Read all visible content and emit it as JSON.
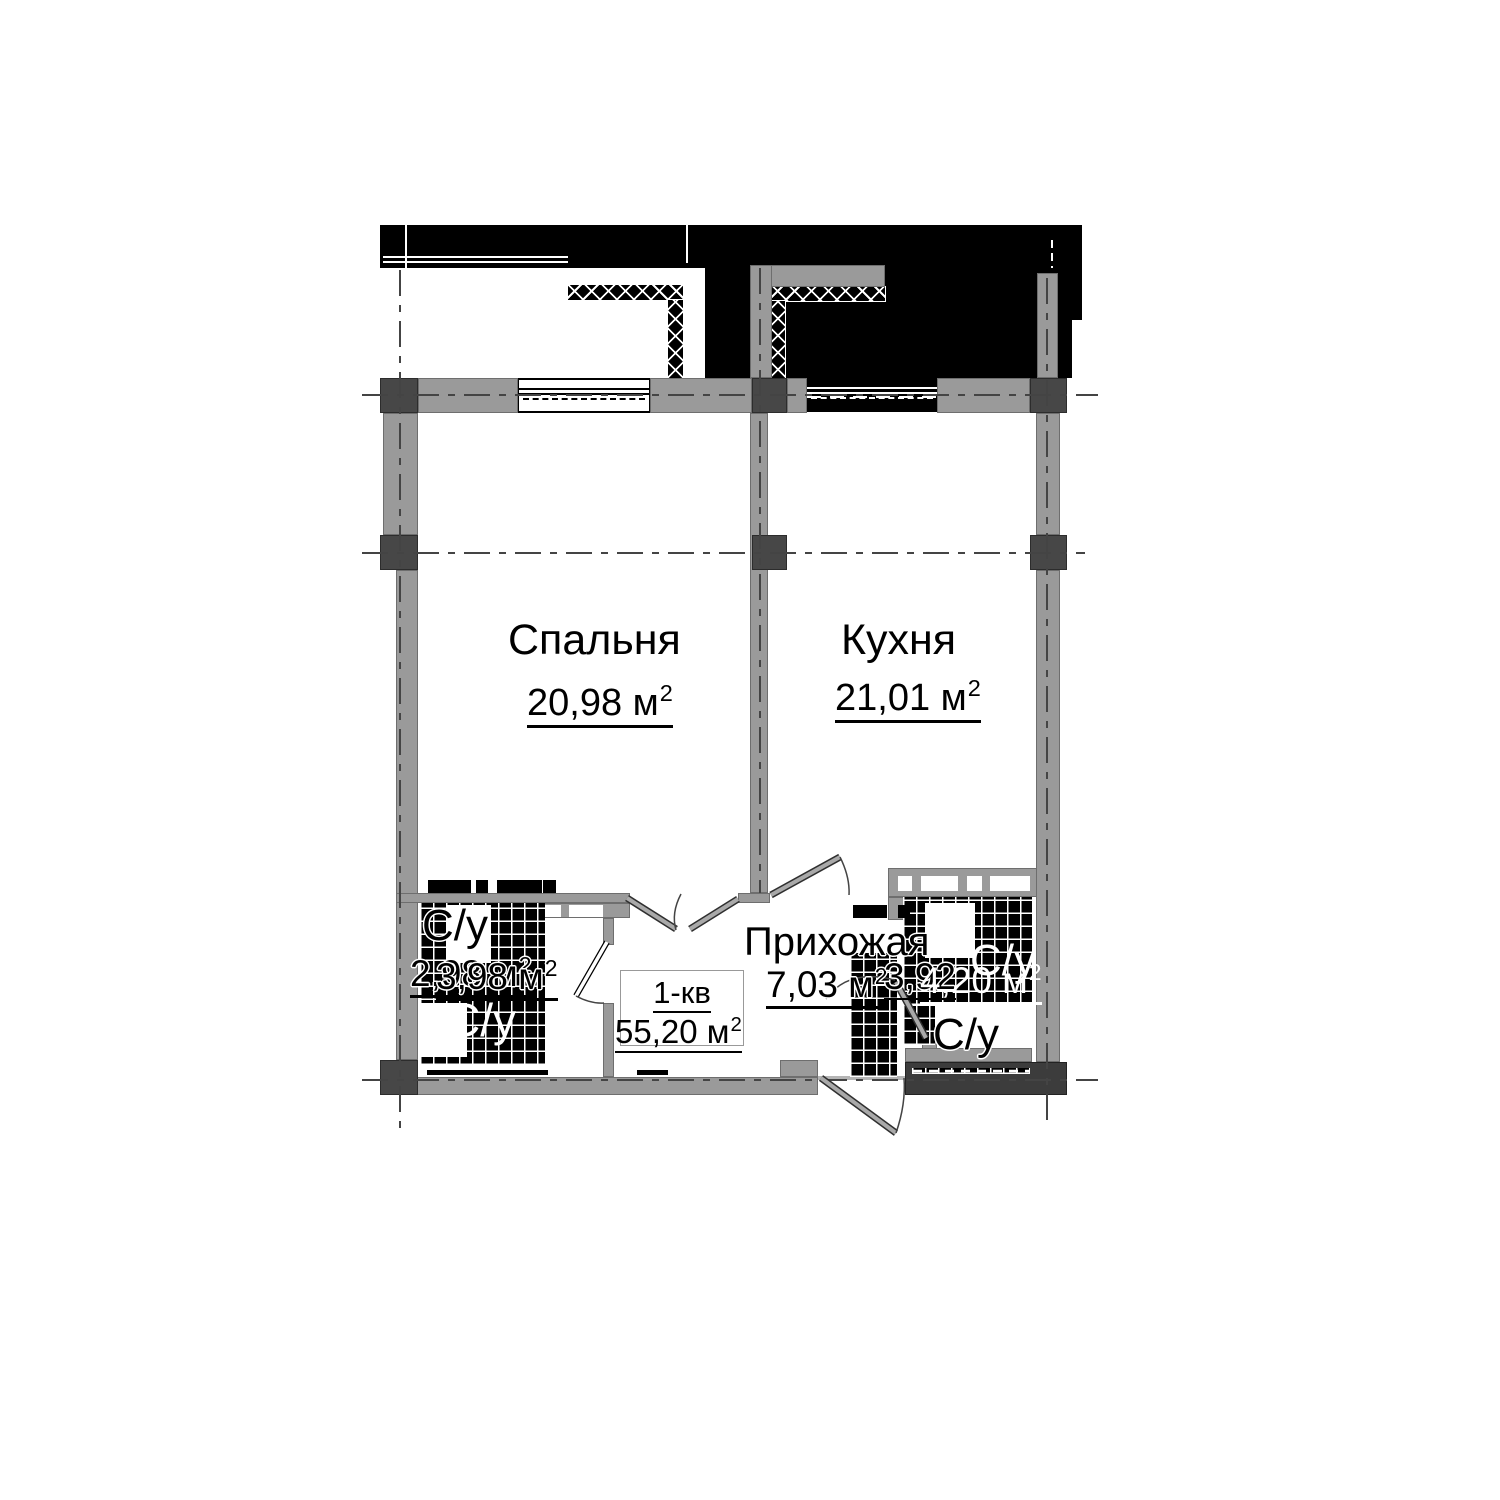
{
  "plan": {
    "sup": "2",
    "apartment": {
      "label": "1-кв",
      "area": "55,20 м"
    },
    "rooms": {
      "bedroom": {
        "name": "Спальня",
        "area": "20,98 м"
      },
      "kitchen": {
        "name": "Кухня",
        "area": "21,01 м"
      },
      "hallway": {
        "name": "Прихожая",
        "area": "7,03 м"
      },
      "bathroom_left": {
        "label_top": "С/у",
        "label_bottom": "С/у",
        "area_a": "2,98 м",
        "area_b": "3,98 м"
      },
      "bathroom_right": {
        "label_top": "С/у",
        "label_bottom": "С/у",
        "area_a": "3,92",
        "area_b": "4,20 м"
      }
    },
    "colors": {
      "wall_gray": "#9a9a9a",
      "column_gray": "#474747",
      "blackout_fill": "#000000",
      "centerline": "#444444",
      "background": "#ffffff"
    }
  }
}
